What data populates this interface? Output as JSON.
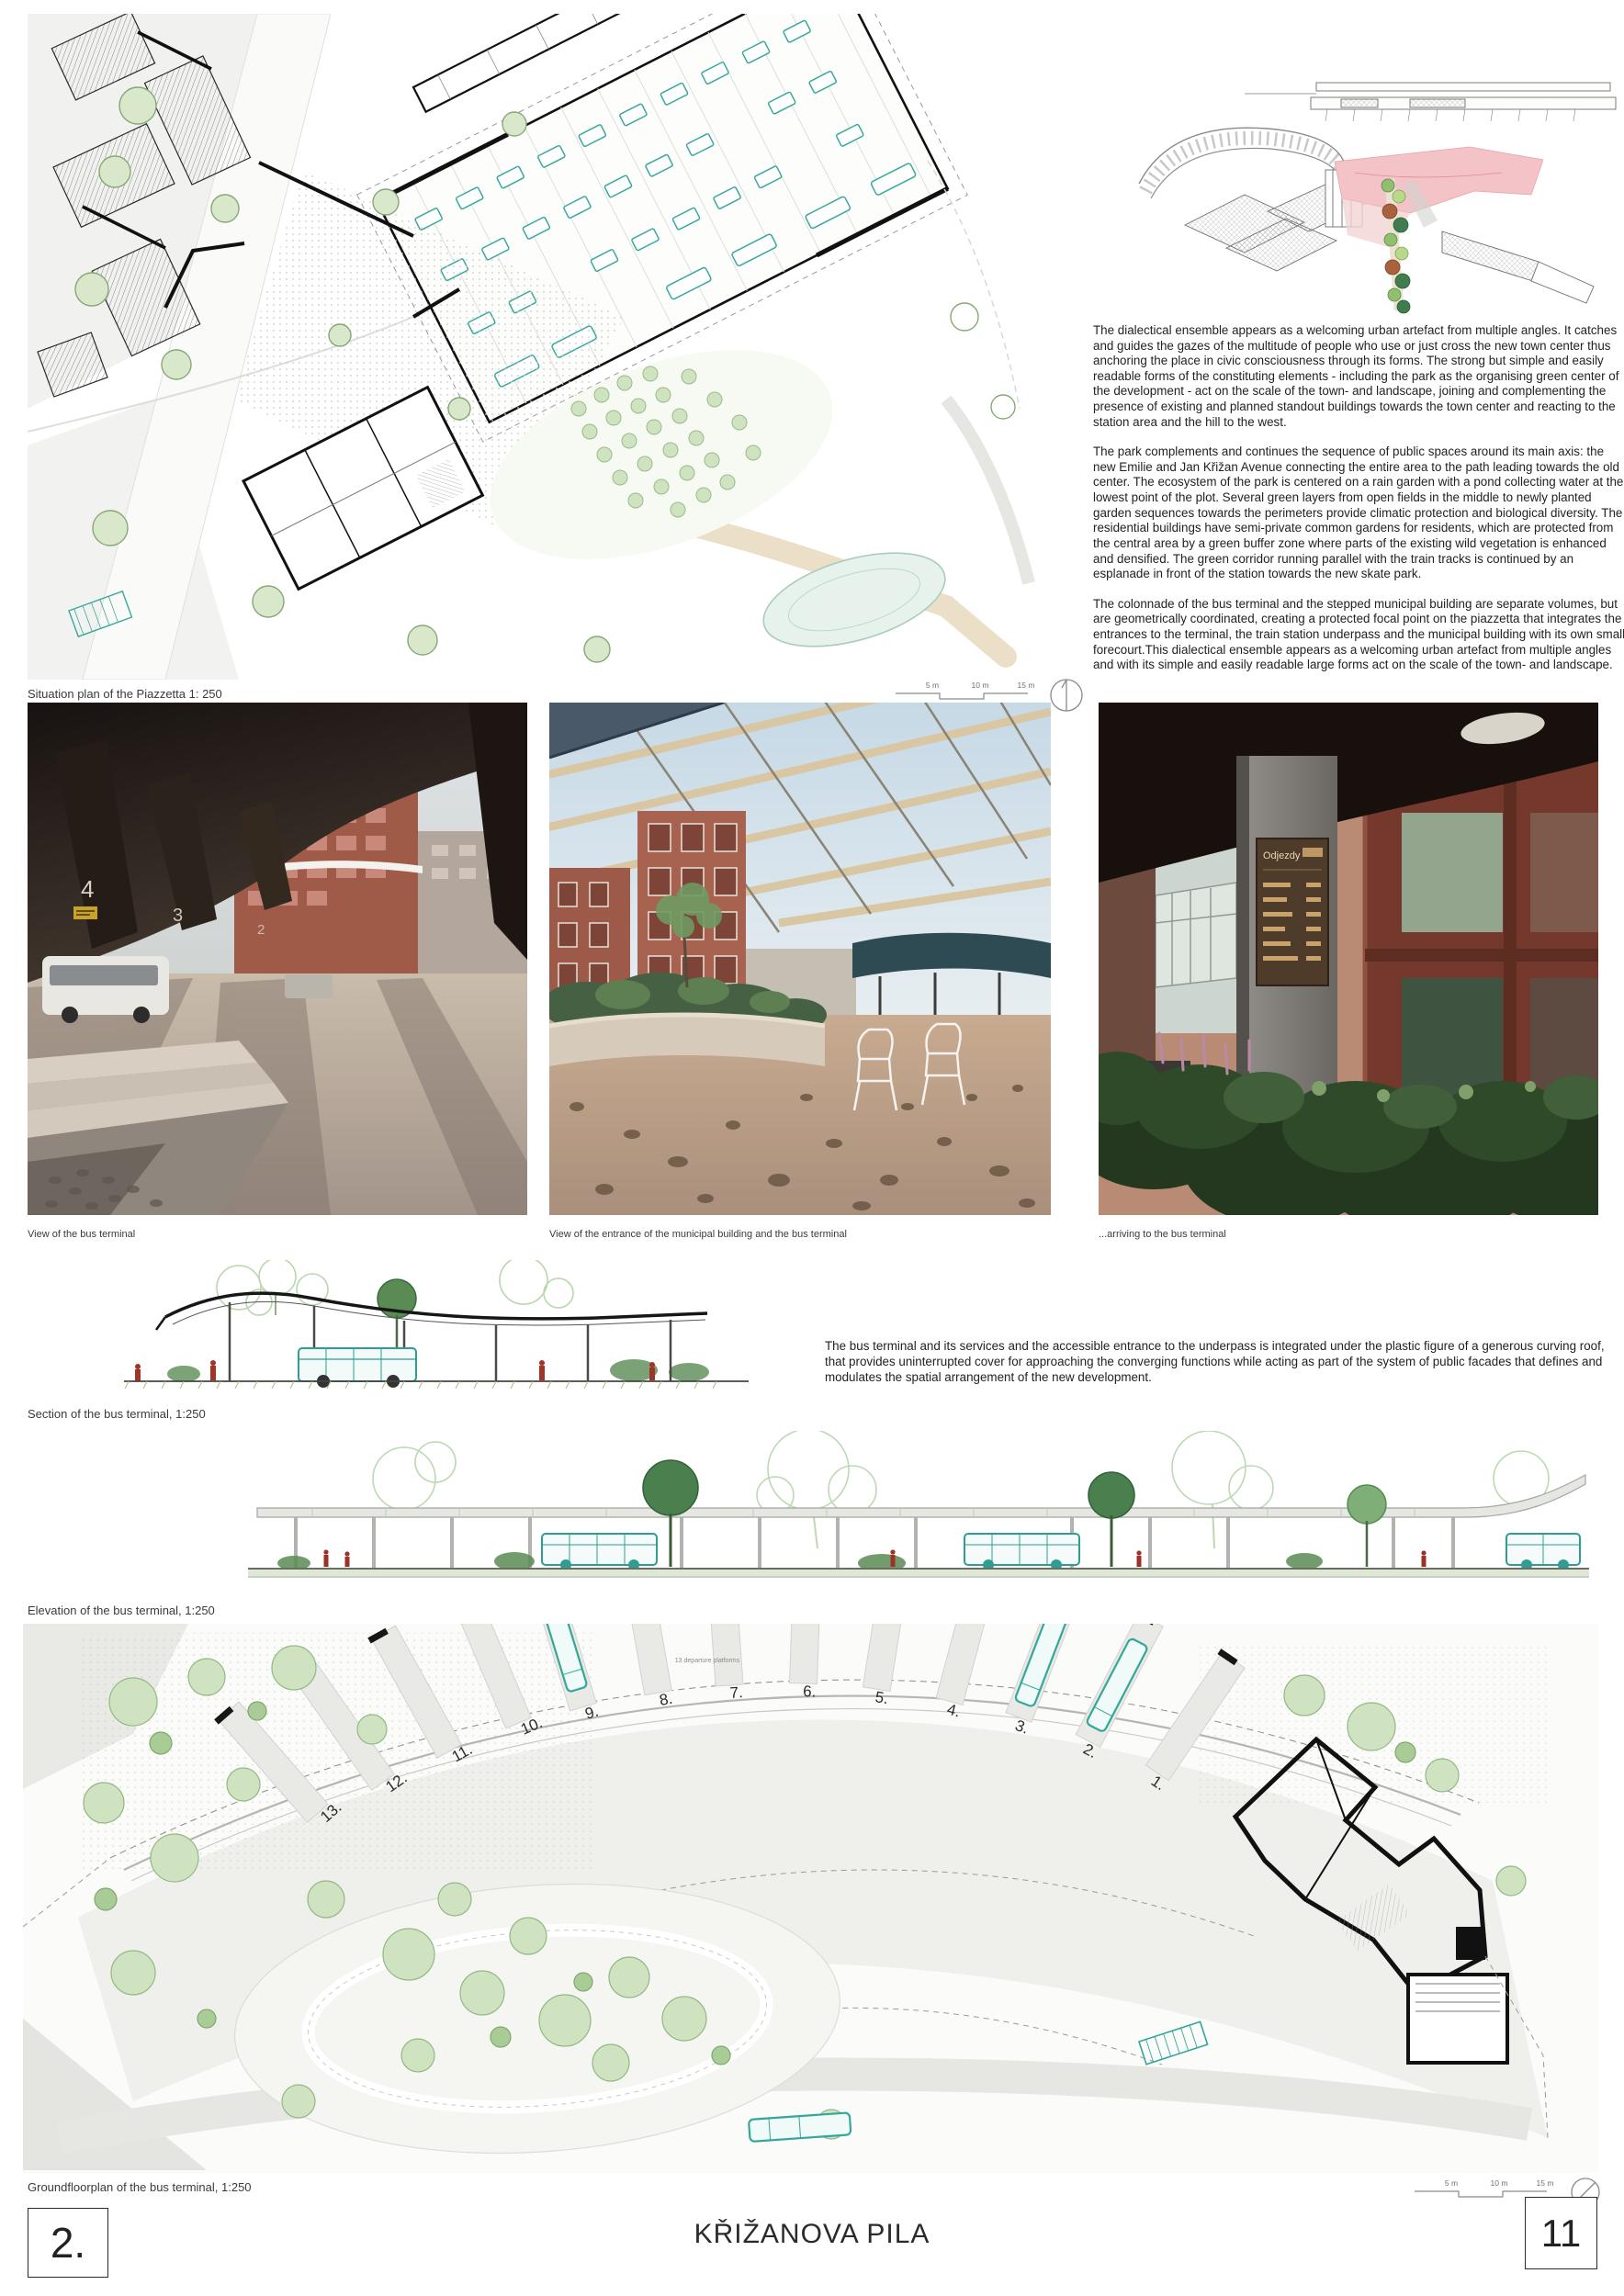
{
  "situation_plan": {
    "caption": "Situation plan of the Piazzetta 1: 250",
    "scale_labels": [
      "5 m",
      "10 m",
      "15 m"
    ]
  },
  "description": {
    "para1": "The dialectical ensemble appears as a welcoming urban artefact from multiple angles. It catches and guides the gazes of the multitude of people who use or just cross the new town center thus anchoring the place in civic consciousness through its forms. The strong but simple and easily readable forms of the constituting elements - including the park as the organising green center of the development - act on the scale of the town- and landscape, joining and complementing the presence of existing and planned standout buildings towards the town center and reacting to the station area and the hill to the west.",
    "para2": "The park complements and continues the  sequence of public spaces around its main axis: the new Emilie and Jan Křižan Avenue connecting the entire area to the path leading towards the old center. The ecosystem of the park is centered on a rain garden with a pond collecting water at the lowest point of the plot. Several green layers from open fields in the middle to newly planted garden sequences towards the perimeters provide climatic protection and biological diversity. The residential buildings have semi-private common gardens for residents, which are protected from the central area by a green buffer zone where parts of the existing wild vegetation is enhanced and densified. The green corridor running parallel with the train tracks is continued by an esplanade in front of the station towards the new skate park.",
    "para3": "The colonnade of the bus terminal and the stepped municipal building are separate volumes, but are geometrically coordinated, creating a protected focal point on the piazzetta that integrates the entrances to the terminal, the train station underpass and the municipal building with its own small forecourt.This dialectical ensemble appears as a welcoming urban artefact from multiple angles and with its simple and easily readable large forms act on the scale of the town- and landscape."
  },
  "photos": [
    {
      "caption": "View of the bus terminal",
      "platform_numbers": [
        "4",
        "3",
        "2"
      ]
    },
    {
      "caption": "View of the entrance of the municipal building and the bus terminal"
    },
    {
      "caption": "...arriving to the bus terminal",
      "sign_title": "Odjezdy"
    }
  ],
  "section": {
    "caption": "Section of the bus terminal, 1:250"
  },
  "terminal_text": "The bus terminal and its services and the accessible entrance to the underpass  is integrated under the plastic figure of a generous curving roof, that provides uninterrupted cover for approaching the converging functions while acting as part of the system of public facades that defines and modulates the spatial arrangement of the new development.",
  "elevation": {
    "caption": "Elevation of the bus terminal, 1:250"
  },
  "groundplan": {
    "caption": "Groundfloorplan of the bus terminal, 1:250",
    "platforms_label": "13 departure platforms",
    "bays": [
      "1.",
      "2.",
      "3.",
      "4.",
      "5.",
      "6.",
      "7.",
      "8.",
      "9.",
      "10.",
      "11.",
      "12.",
      "13."
    ],
    "scale_labels": [
      "5 m",
      "10 m",
      "15 m"
    ]
  },
  "footer": {
    "panel_number": "2.",
    "title": "KŘIŽANOVA PILA",
    "page_number": "11"
  },
  "colors": {
    "accent_teal": "#38a79a",
    "plan_green": "#cfe3c0",
    "axon_pink": "#f4c3c7",
    "brick": "#9d5a49",
    "canopy_dark": "#1d1613"
  }
}
